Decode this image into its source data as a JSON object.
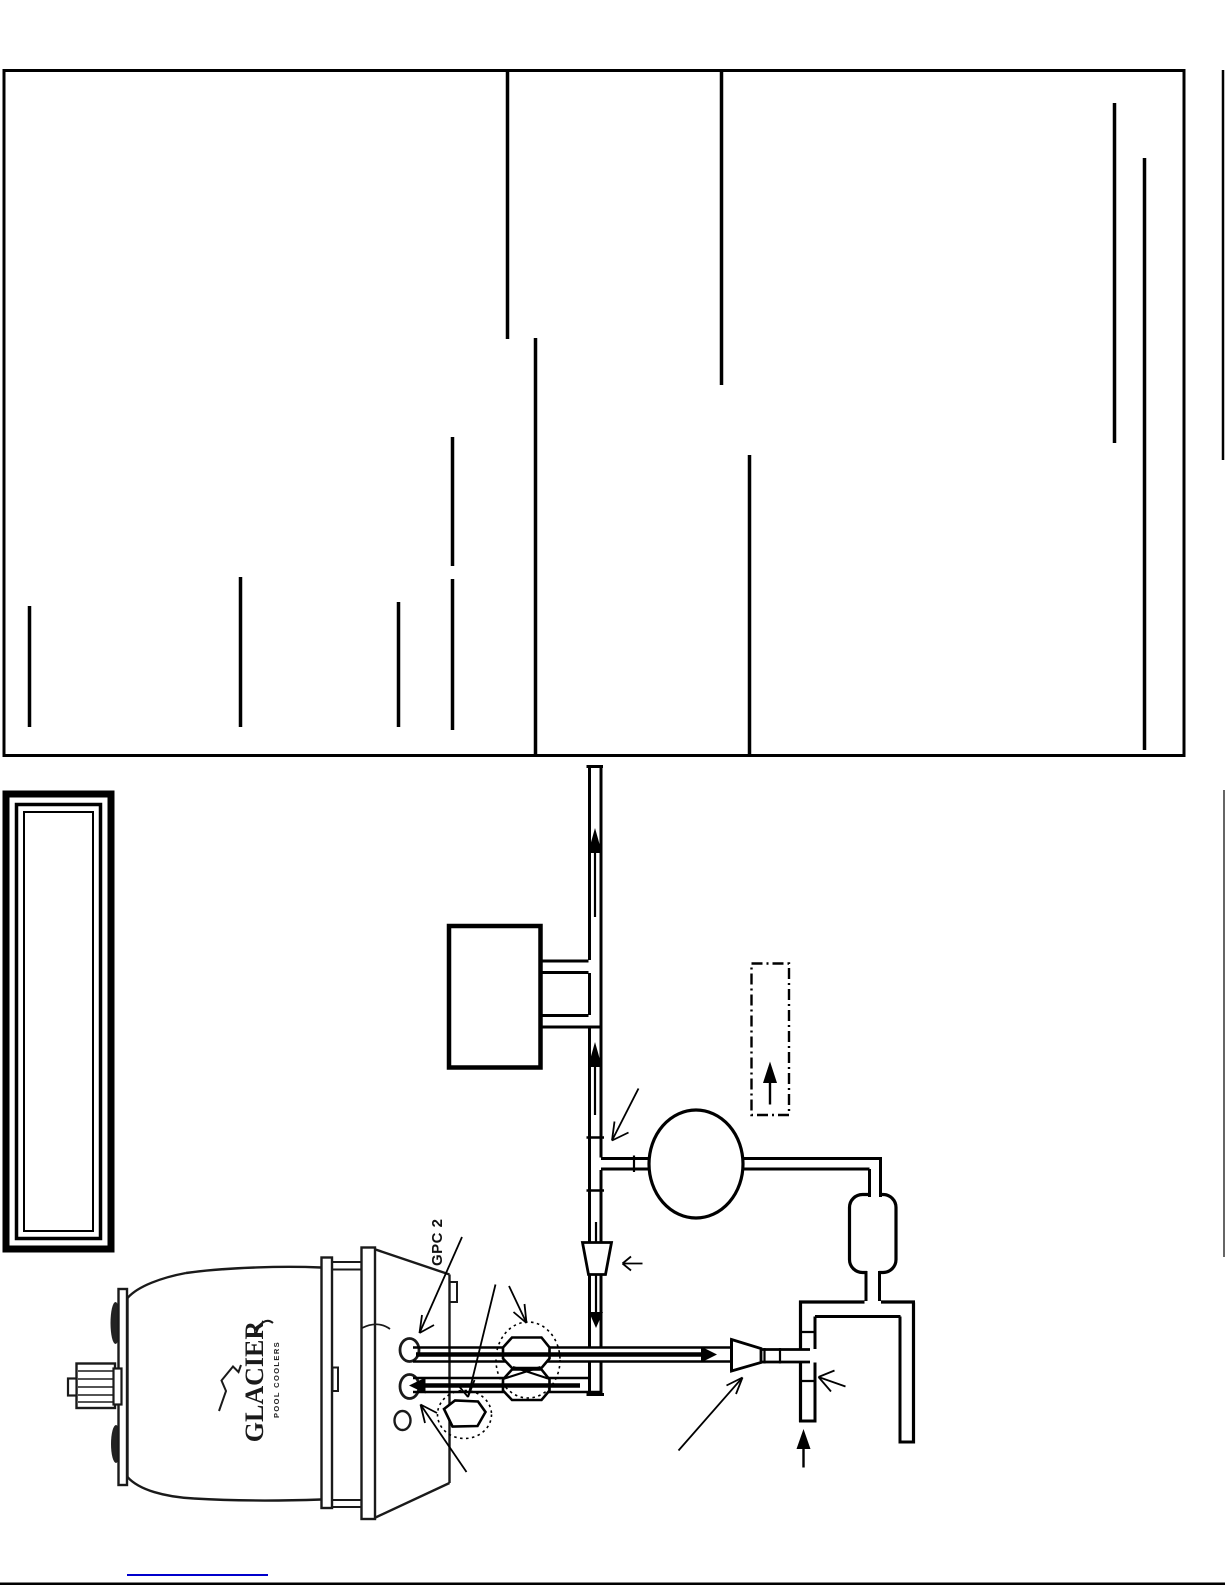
{
  "document": {
    "background": "#ffffff",
    "ink_color": "#000000",
    "link_color": "#0000cc"
  },
  "diagram": {
    "unit_label": "GPC 2",
    "brand": "GLACIER",
    "brand_subtitle": "POOL COOLERS",
    "footer_link_text": ""
  }
}
